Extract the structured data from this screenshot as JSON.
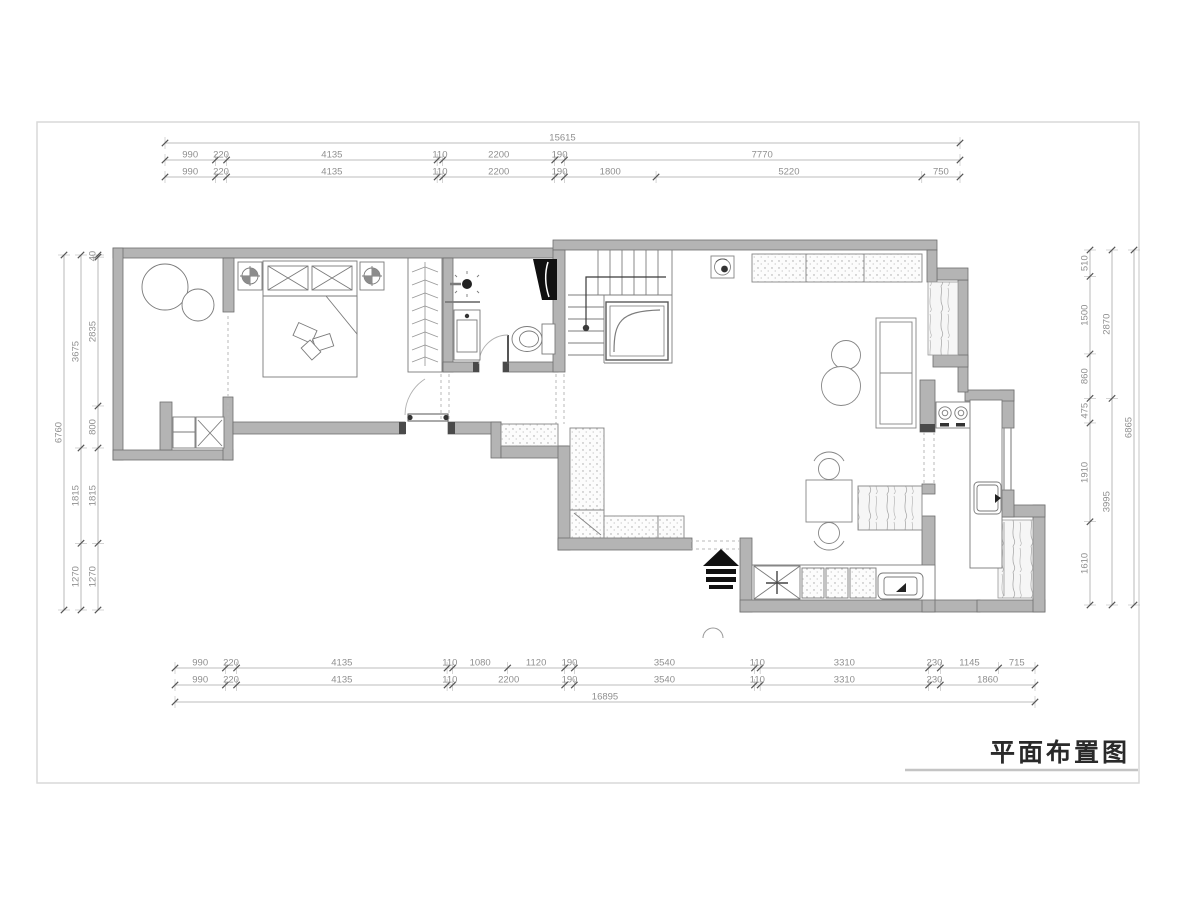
{
  "title": {
    "text": "平面布置图"
  },
  "colors": {
    "wall_fill": "#b4b4b4",
    "wall_stroke": "#6e6e6e",
    "furniture_line": "#7a7a7a",
    "dim_line": "#a9a9a9",
    "dim_tick": "#555555",
    "dim_text": "#8f8f8f",
    "frame": "#d9d9d9",
    "shaft_fill": "#101010"
  },
  "dimensions": {
    "top": {
      "total": "15615",
      "rows": [
        {
          "segments": [
            "990",
            "220",
            "4135",
            "110",
            "2200",
            "190",
            "7770"
          ]
        },
        {
          "segments": [
            "990",
            "220",
            "4135",
            "110",
            "2200",
            "190",
            "1800",
            "5220",
            "750"
          ]
        }
      ]
    },
    "bottom": {
      "total": "16895",
      "rows": [
        {
          "segments": [
            "990",
            "220",
            "4135",
            "110",
            "1080",
            "1120",
            "190",
            "3540",
            "110",
            "3310",
            "230",
            "1145",
            "715"
          ]
        },
        {
          "segments": [
            "990",
            "220",
            "4135",
            "110",
            "2200",
            "190",
            "3540",
            "110",
            "3310",
            "230",
            "1860"
          ]
        }
      ]
    },
    "left": {
      "total": "6760",
      "rows": [
        {
          "segments": [
            "3675",
            "1815",
            "1270"
          ]
        },
        {
          "segments": [
            "40",
            "2835",
            "800",
            "1815",
            "1270"
          ]
        }
      ]
    },
    "right": {
      "total": "6865",
      "rows": [
        {
          "segments": [
            "510",
            "1500",
            "860",
            "475",
            "1910",
            "1610"
          ]
        },
        {
          "segments": [
            "2870",
            "3995"
          ]
        }
      ]
    }
  }
}
